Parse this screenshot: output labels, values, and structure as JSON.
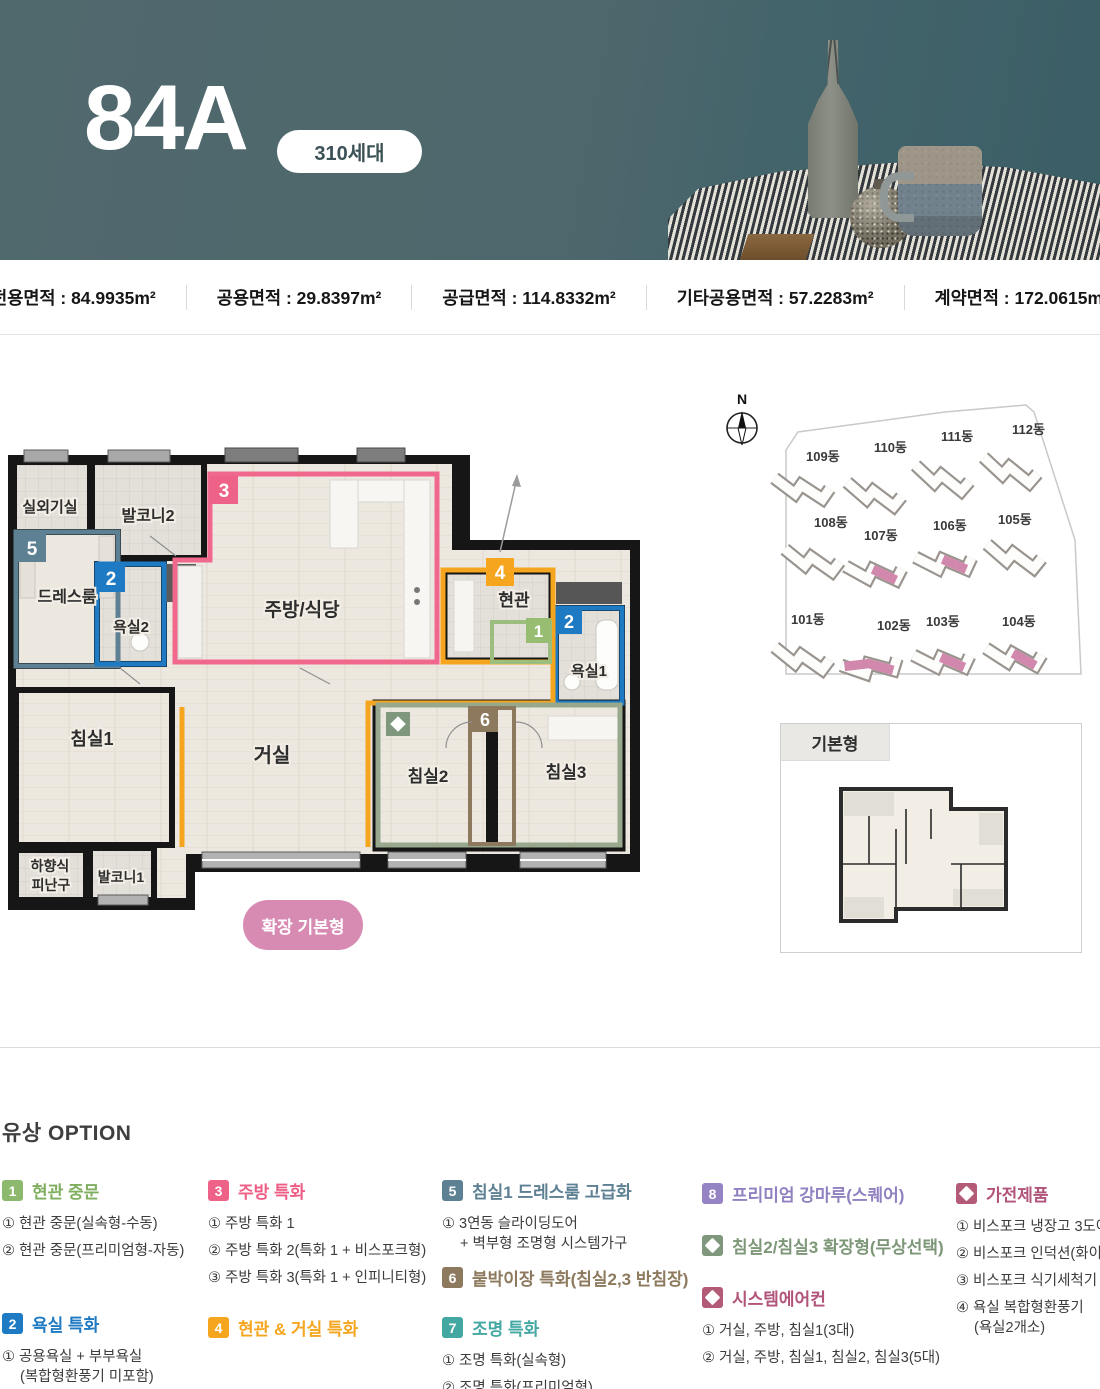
{
  "header": {
    "unit_type": "84A",
    "units_badge": "310세대"
  },
  "area_bar": {
    "items": [
      {
        "text": "전용면적 : 84.9935m²"
      },
      {
        "text": "공용면적 : 29.8397m²"
      },
      {
        "text": "공급면적 : 114.8332m²"
      },
      {
        "text": "기타공용면적 : 57.2283m²"
      },
      {
        "text": "계약면적 : 172.0615m²"
      }
    ]
  },
  "floor_plan": {
    "rooms": {
      "outdoor": "실외기실",
      "balcony2": "발코니2",
      "dress": "드레스룸",
      "bath2": "욕실2",
      "kitchen": "주방/식당",
      "entry": "현관",
      "bath1": "욕실1",
      "bed1": "침실1",
      "living": "거실",
      "bed2": "침실2",
      "bed3": "침실3",
      "evac1": "하향식",
      "evac2": "피난구",
      "balcony1": "발코니1"
    },
    "badges": {
      "green": "1",
      "blue": "2",
      "pink": "3",
      "orange": "4",
      "slate": "5",
      "brown": "6"
    },
    "badge_colors": {
      "green": "#97bd72",
      "blue": "#1e7ac2",
      "pink": "#ef6287",
      "orange": "#f6a61e",
      "slate": "#5d8093",
      "brown": "#8d7a5e"
    },
    "expand_badge": "확장 기본형",
    "expand_badge_color": "#d78ab2"
  },
  "site_plan": {
    "compass": "N",
    "buildings": [
      {
        "name": "109동",
        "highlight": false
      },
      {
        "name": "110동",
        "highlight": false
      },
      {
        "name": "111동",
        "highlight": false
      },
      {
        "name": "112동",
        "highlight": false
      },
      {
        "name": "108동",
        "highlight": false
      },
      {
        "name": "107동",
        "highlight": true
      },
      {
        "name": "106동",
        "highlight": true
      },
      {
        "name": "105동",
        "highlight": false
      },
      {
        "name": "101동",
        "highlight": false
      },
      {
        "name": "102동",
        "highlight": true
      },
      {
        "name": "103동",
        "highlight": true
      },
      {
        "name": "104동",
        "highlight": true
      }
    ],
    "highlight_color": "#d287ac"
  },
  "base_plan": {
    "label": "기본형"
  },
  "options": {
    "title": "유상 OPTION",
    "groups": [
      {
        "num": "1",
        "title": "현관 중문",
        "color": "#7fae5f",
        "items": [
          "① 현관 중문(실속형-수동)",
          "② 현관 중문(프리미엄형-자동)"
        ]
      },
      {
        "num": "2",
        "title": "욕실 특화",
        "color": "#1e7ac2",
        "items": [
          "① 공용욕실 + 부부욕실",
          "(복합형환풍기 미포함)"
        ]
      },
      {
        "num": "3",
        "title": "주방 특화",
        "color": "#ee5e84",
        "items": [
          "① 주방 특화 1",
          "② 주방 특화 2(특화 1 + 비스포크형)",
          "③ 주방 특화 3(특화 1 + 인피니티형)"
        ]
      },
      {
        "num": "4",
        "title": "현관 & 거실 특화",
        "color": "#f6a61e",
        "items": []
      },
      {
        "num": "5",
        "title": "침실1 드레스룸 고급화",
        "color": "#5d8093",
        "items": [
          "① 3연동 슬라이딩도어",
          "+ 벽부형 조명형 시스템가구"
        ]
      },
      {
        "num": "6",
        "title": "붙박이장 특화(침실2,3 반침장)",
        "color": "#8d7a5e",
        "items": []
      },
      {
        "num": "7",
        "title": "조명 특화",
        "color": "#44a8a2",
        "items": [
          "① 조명 특화(실속형)",
          "② 조명 특화(프리미엄형)"
        ]
      },
      {
        "num": "8",
        "title": "프리미엄 강마루(스퀘어)",
        "color": "#9181c0",
        "items": []
      },
      {
        "icon": "diamond",
        "title": "침실2/침실3 확장형(무상선택)",
        "color": "#7d9778",
        "items": []
      },
      {
        "icon": "diamond",
        "title": "시스템에어컨",
        "color": "#b2537a",
        "items": [
          "① 거실, 주방, 침실1(3대)",
          "② 거실, 주방, 침실1, 침실2, 침실3(5대)"
        ]
      },
      {
        "icon": "diamond",
        "title": "가전제품",
        "color": "#b2537a",
        "items": [
          "① 비스포크 냉장고 3도어",
          "② 비스포크 인덕션(화이트)",
          "③ 비스포크 식기세척기",
          "④ 욕실 복합형환풍기",
          "(욕실2개소)"
        ]
      }
    ]
  }
}
